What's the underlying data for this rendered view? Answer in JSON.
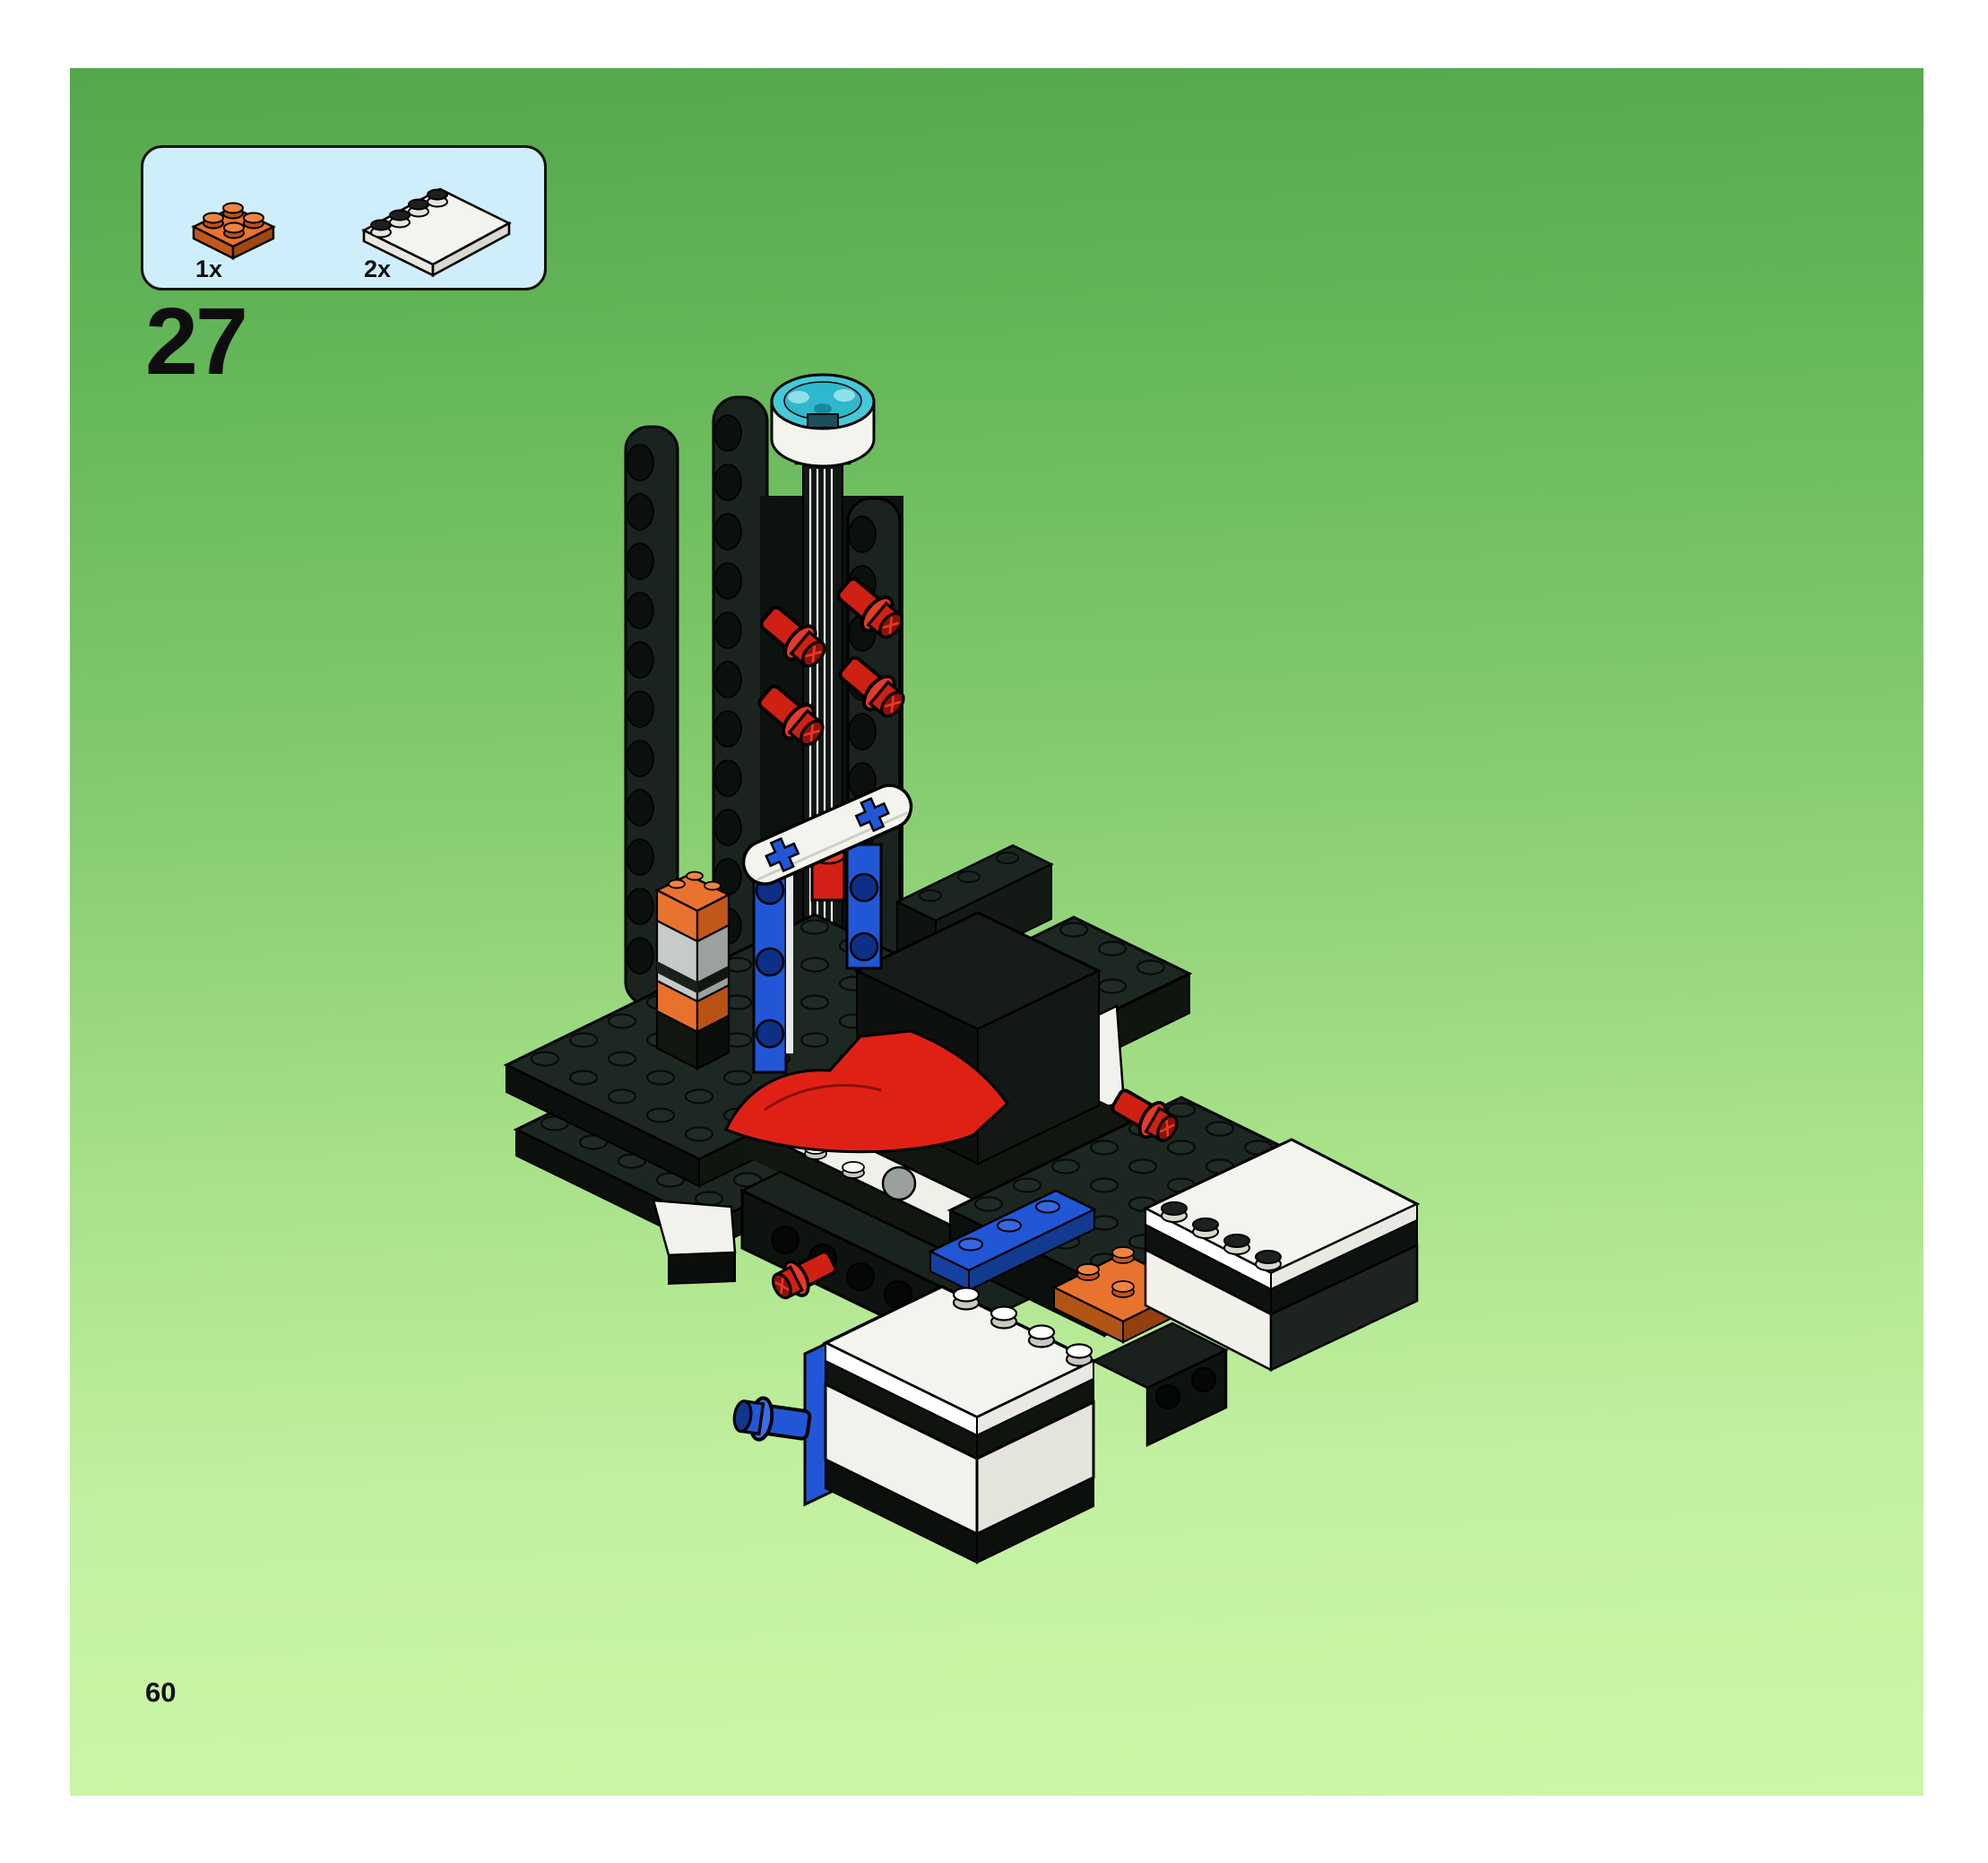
{
  "page": {
    "step_number": "27",
    "page_number": "60"
  },
  "parts_callout": {
    "items": [
      {
        "quantity": "1x",
        "part_name": "orange-2x2-plate",
        "color": "#e8732e"
      },
      {
        "quantity": "2x",
        "part_name": "white-4x4-tile-with-edge-studs",
        "color": "#f4f4ef"
      }
    ]
  },
  "palette": {
    "page_green_top": "#54a74c",
    "page_green_bottom": "#cdf7a8",
    "callout_background": "#cfeefb",
    "black_part": "#1e2822",
    "blue_part": "#2157d6",
    "red_part": "#df2115",
    "orange_part": "#e8732e",
    "white_part": "#f4f4ef",
    "gray_part": "#c6cbc9",
    "teal_dome": "#45c8d8"
  }
}
